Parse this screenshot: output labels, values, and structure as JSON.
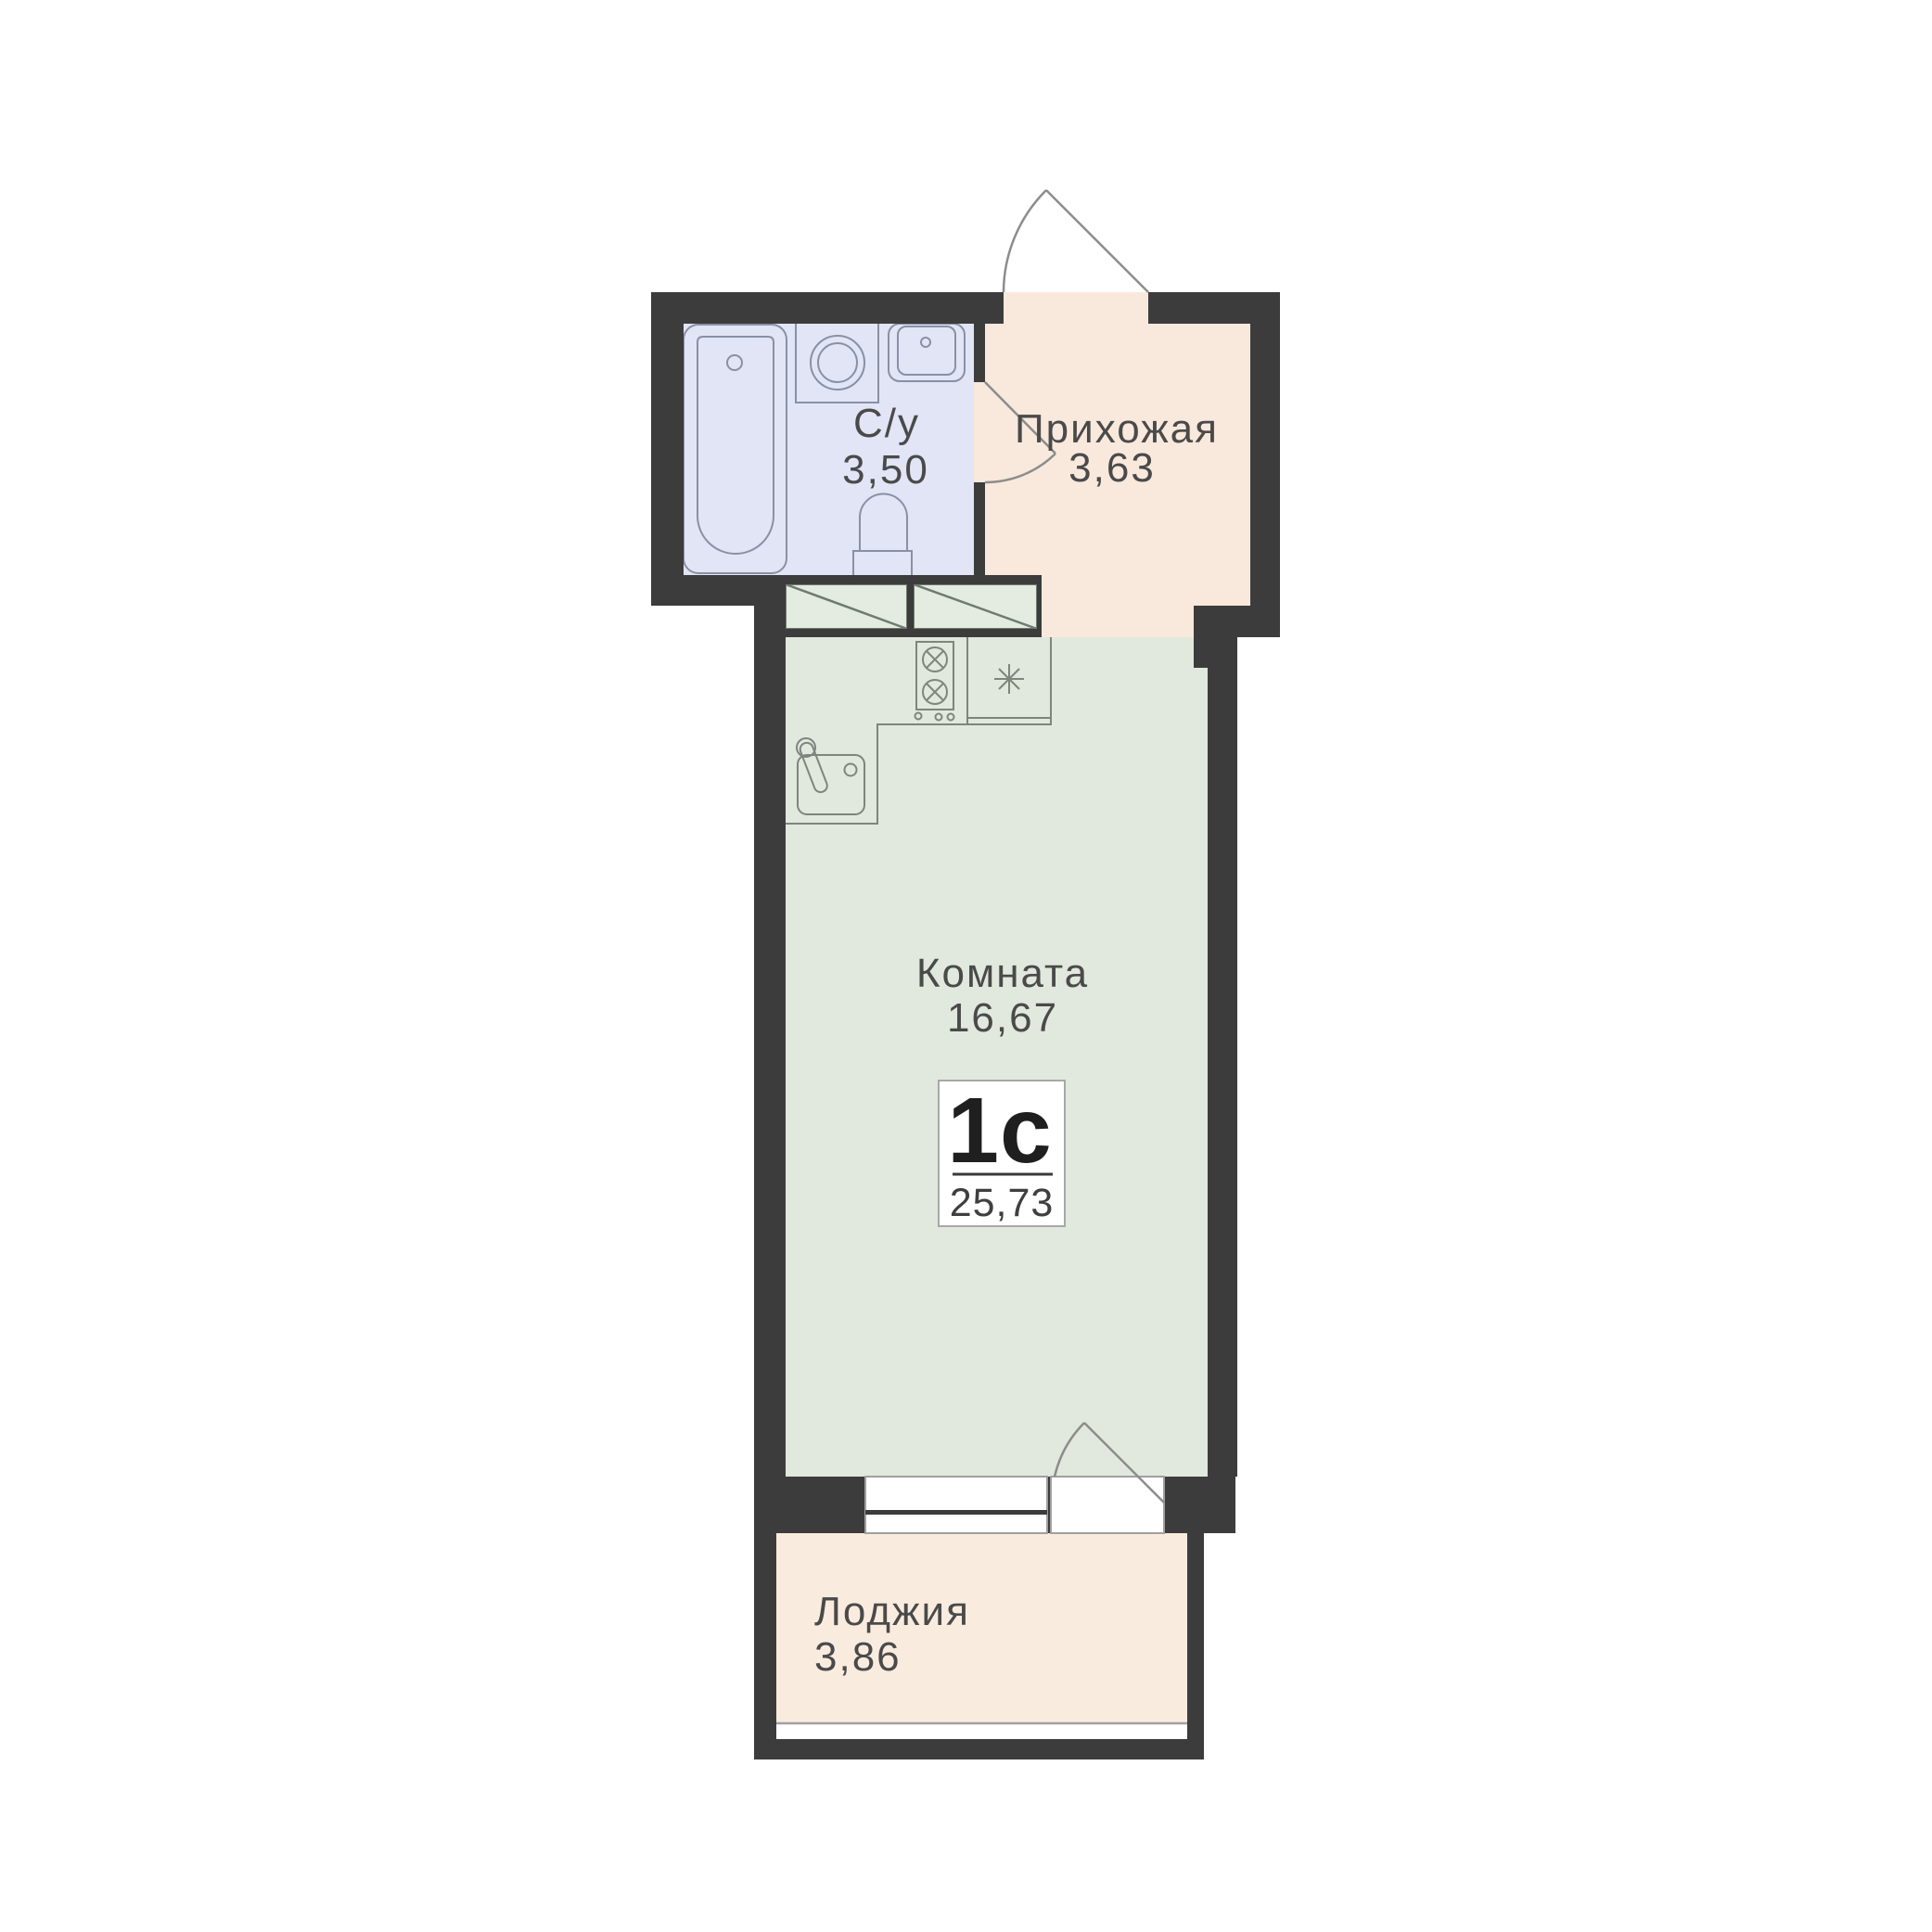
{
  "plan": {
    "badge": {
      "type_label": "1с",
      "area_label": "25,73"
    },
    "rooms": {
      "bathroom": {
        "name": "С/у",
        "area": "3,50"
      },
      "hallway": {
        "name": "Прихожая",
        "area": "3,63"
      },
      "living_room": {
        "name": "Комната",
        "area": "16,67"
      },
      "loggia": {
        "name": "Лоджия",
        "area": "3,86"
      }
    },
    "colors": {
      "wall": "#3d3c3d",
      "bathroom_floor": "#e1e5f6",
      "hallway_floor": "#f8e9dc",
      "living_floor": "#e1e8dd",
      "loggia_floor": "#f9ecdf",
      "closet_fill": "#e4ebe0",
      "fixture_stroke": "#7d857e",
      "bath_fixture_stroke": "#8a90a4",
      "door_stroke": "#8c8c8c",
      "frame_stroke": "#a0a0a0",
      "text": "#4a4a4a",
      "badge_border": "#a8a8a8",
      "badge_divider": "#3a3a3a"
    },
    "icons": [
      "bathtub-icon",
      "washing-machine-icon",
      "bathroom-sink-icon",
      "toilet-icon",
      "wardrobe-icon",
      "stove-icon",
      "fridge-snowflake-icon",
      "kitchen-sink-icon",
      "entrance-door-swing-icon",
      "bathroom-door-swing-icon",
      "balcony-door-swing-icon",
      "window-icon",
      "loggia-glazing-icon"
    ]
  }
}
